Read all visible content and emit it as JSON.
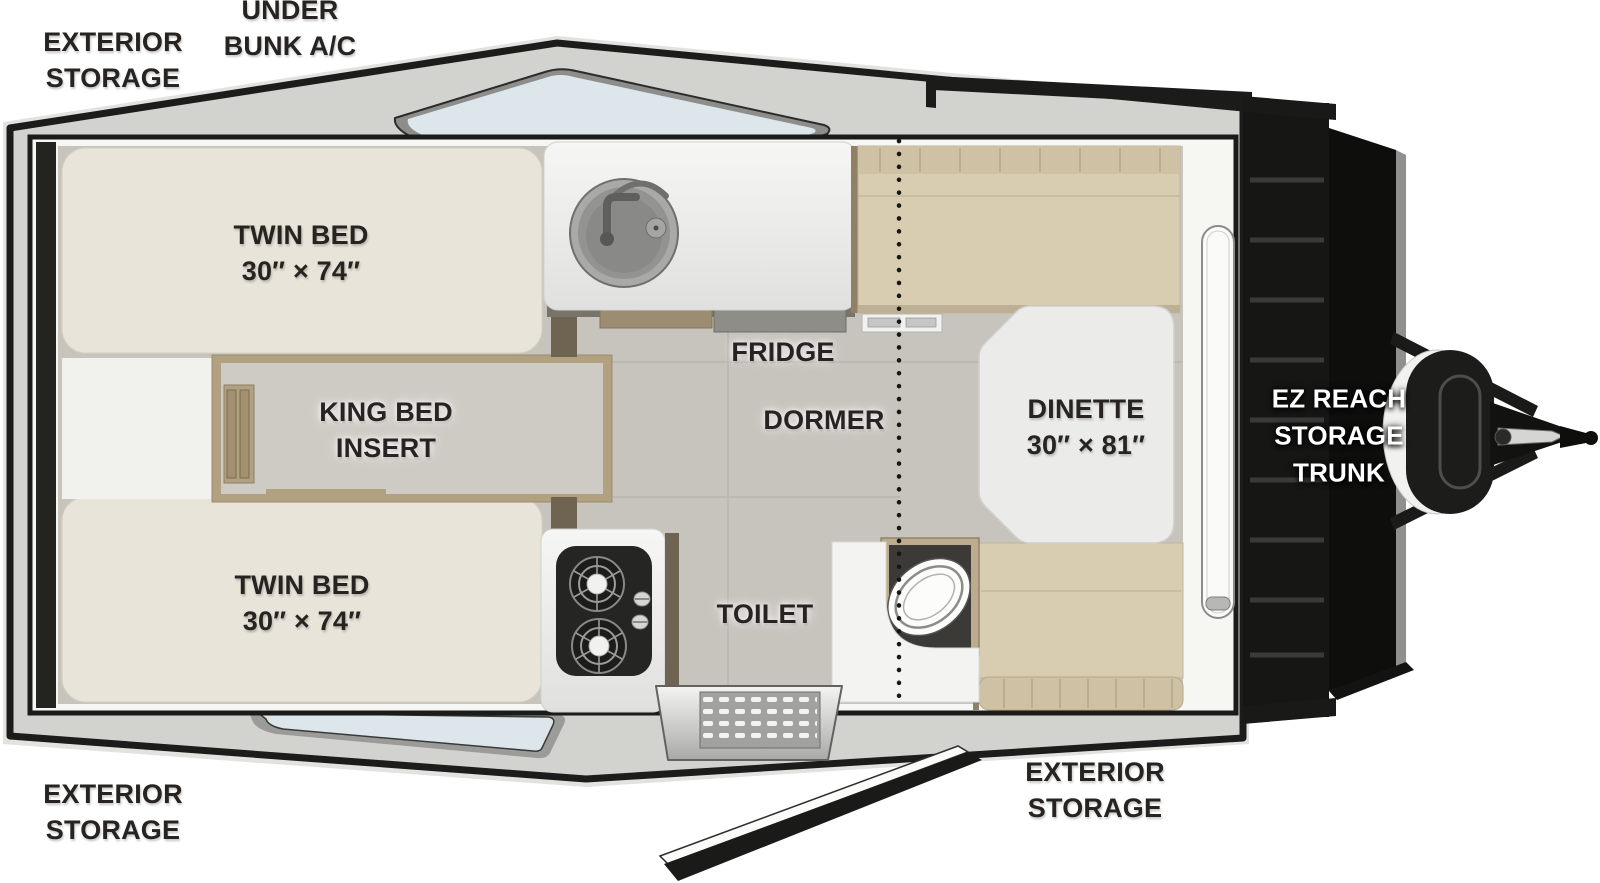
{
  "labels": {
    "exterior_storage_top_left": {
      "line1": "EXTERIOR",
      "line2": "STORAGE"
    },
    "under_bunk_ac": {
      "line1": "UNDER",
      "line2": "BUNK A/C"
    },
    "twin_bed_top": {
      "line1": "TWIN BED",
      "line2": "30″ × 74″"
    },
    "king_bed_insert": {
      "line1": "KING BED",
      "line2": "INSERT"
    },
    "twin_bed_bottom": {
      "line1": "TWIN BED",
      "line2": "30″ × 74″"
    },
    "fridge": {
      "text": "FRIDGE"
    },
    "dormer": {
      "text": "DORMER"
    },
    "dinette": {
      "line1": "DINETTE",
      "line2": "30″ × 81″"
    },
    "toilet": {
      "text": "TOILET"
    },
    "ez_reach_storage_trunk": {
      "line1": "EZ REACH",
      "line2": "STORAGE",
      "line3": "TRUNK"
    },
    "exterior_storage_bottom_left": {
      "line1": "EXTERIOR",
      "line2": "STORAGE"
    },
    "exterior_storage_bottom_right": {
      "line1": "EXTERIOR",
      "line2": "STORAGE"
    }
  },
  "colors": {
    "body_outline": "#1c1c1b",
    "deck_gray": "#d2d2cf",
    "floor_gray": "#c7c4be",
    "cushion_cream": "#e9e4d9",
    "cushion_tan": "#d8ccb1",
    "wood": "#b2a180",
    "window_glass": "#dce6eb",
    "trunk_black": "#161615",
    "label_text": "#262321",
    "trunk_label_text": "#ffffff"
  }
}
